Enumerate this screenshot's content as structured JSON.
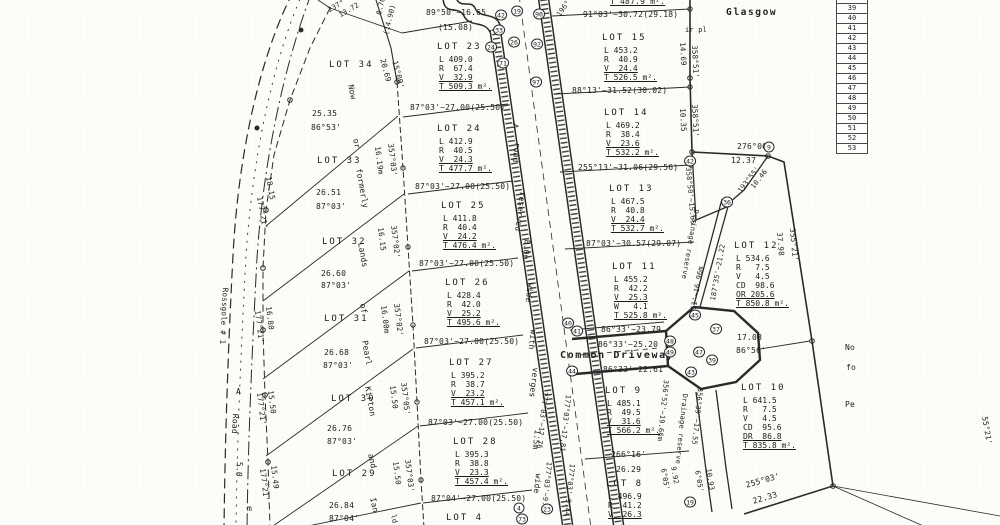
{
  "colors": {
    "ink": "#1c1c1c",
    "paper": "#fcfcf9"
  },
  "ref_table": {
    "rows": [
      "38",
      "39",
      "40",
      "41",
      "42",
      "43",
      "44",
      "45",
      "46",
      "47",
      "48",
      "49",
      "50",
      "51",
      "52",
      "53"
    ]
  },
  "lots": [
    {
      "name": "LOT 23",
      "x": 437,
      "y": 42,
      "rows": [
        "L 409.0",
        "R  67.4",
        "V  32.9",
        "T 509.3 m²."
      ],
      "u": [
        2,
        3
      ]
    },
    {
      "name": "LOT 24",
      "x": 437,
      "y": 124,
      "rows": [
        "L 412.9",
        "R  40.5",
        "V  24.3",
        "T 477.7 m²."
      ],
      "u": [
        2,
        3
      ]
    },
    {
      "name": "LOT 25",
      "x": 441,
      "y": 201,
      "rows": [
        "L 411.8",
        "R  40.4",
        "V  24.2",
        "T 476.4 m²."
      ],
      "u": [
        2,
        3
      ]
    },
    {
      "name": "LOT 26",
      "x": 445,
      "y": 278,
      "rows": [
        "L 428.4",
        "R  42.0",
        "V  25.2",
        "T 495.6 m²."
      ],
      "u": [
        2,
        3
      ]
    },
    {
      "name": "LOT 27",
      "x": 449,
      "y": 358,
      "rows": [
        "L 395.2",
        "R  38.7",
        "V  23.2",
        "T 457.1 m²."
      ],
      "u": [
        2,
        3
      ]
    },
    {
      "name": "LOT 28",
      "x": 453,
      "y": 437,
      "rows": [
        "L 395.3",
        "R  38.8",
        "V  23.3",
        "T 457.4 m²."
      ],
      "u": [
        2,
        3
      ]
    },
    {
      "name": "LOT 15",
      "x": 602,
      "y": 33,
      "rows": [
        "L 453.2",
        "R  40.9",
        "V  24.4",
        "T 526.5 m²."
      ],
      "u": [
        2,
        3
      ]
    },
    {
      "name": "LOT 14",
      "x": 604,
      "y": 108,
      "rows": [
        "L 469.2",
        "R  38.4",
        "V  23.6",
        "T 532.2 m²."
      ],
      "u": [
        2,
        3
      ]
    },
    {
      "name": "LOT 13",
      "x": 609,
      "y": 184,
      "rows": [
        "L 467.5",
        "R  40.8",
        "V  24.4",
        "T 532.7 m²."
      ],
      "u": [
        2,
        3
      ]
    },
    {
      "name": "LOT 11",
      "x": 612,
      "y": 262,
      "rows": [
        "L 455.2",
        "R  42.2",
        "V  25.3",
        "W   4.1",
        "T 525.8 m²."
      ],
      "u": [
        2,
        4
      ]
    },
    {
      "name": "LOT 12",
      "x": 734,
      "y": 241,
      "rows": [
        "L 534.6",
        "R   7.5",
        "V   4.5",
        "CD  98.6",
        "OR 205.6",
        "T 850.8 m²."
      ],
      "u": [
        4,
        5
      ]
    },
    {
      "name": "LOT 9",
      "x": 605,
      "y": 386,
      "rows": [
        "L 485.1",
        "R  49.5",
        "V  31.6",
        "T 566.2 m²."
      ],
      "u": [
        2,
        3
      ]
    },
    {
      "name": "LOT 10",
      "x": 741,
      "y": 383,
      "rows": [
        "L 641.5",
        "R   7.5",
        "V   4.5",
        "CD  95.6",
        "DR  86.8",
        "T 835.8 m²."
      ],
      "u": [
        4,
        5
      ]
    },
    {
      "name": "LOT 8",
      "x": 606,
      "y": 479,
      "rows": [
        "L 496.9",
        "R  41.2",
        "V  26.3"
      ],
      "u": [
        2
      ]
    },
    {
      "name": "LOT 34",
      "x": 329,
      "y": 60,
      "rows": [],
      "u": []
    },
    {
      "name": "LOT 33",
      "x": 317,
      "y": 156,
      "rows": [],
      "u": []
    },
    {
      "name": "LOT 32",
      "x": 322,
      "y": 237,
      "rows": [],
      "u": []
    },
    {
      "name": "LOT 31",
      "x": 324,
      "y": 314,
      "rows": [],
      "u": []
    },
    {
      "name": "LOT 30",
      "x": 331,
      "y": 394,
      "rows": [],
      "u": []
    },
    {
      "name": "LOT 29",
      "x": 332,
      "y": 469,
      "rows": [],
      "u": []
    },
    {
      "name": "LOT 4",
      "x": 446,
      "y": 513,
      "rows": [],
      "u": []
    }
  ],
  "labels": [
    {
      "t": "T 487.9 m².",
      "x": 610,
      "y": -2,
      "u": 1
    },
    {
      "t": "89°50'~16.65",
      "x": 426,
      "y": 9
    },
    {
      "t": "(15.08)",
      "x": 438,
      "y": 24
    },
    {
      "t": "91°03'~30.72(29.18)",
      "x": 583,
      "y": 11
    },
    {
      "t": "88°13'~31.52(30.02)",
      "x": 572,
      "y": 87
    },
    {
      "t": "255°13'~31.06(29.56)",
      "x": 578,
      "y": 164
    },
    {
      "t": "87°03'~30.57(29.07)",
      "x": 586,
      "y": 240
    },
    {
      "t": "87°03'~27.00(25.50)",
      "x": 410,
      "y": 104
    },
    {
      "t": "87°03'~27.00(25.50)",
      "x": 415,
      "y": 183
    },
    {
      "t": "87°03'~27.00(25.50)",
      "x": 419,
      "y": 260
    },
    {
      "t": "87°03'~27.00(25.50)",
      "x": 424,
      "y": 338
    },
    {
      "t": "87°03'~27.00(25.50)",
      "x": 428,
      "y": 419
    },
    {
      "t": "87°04'~27.00(25.50)",
      "x": 431,
      "y": 495
    },
    {
      "t": "86°33'~23.79",
      "x": 601,
      "y": 326
    },
    {
      "t": "86°33'~25.20",
      "x": 598,
      "y": 341
    },
    {
      "t": "Common Driveway",
      "x": 560,
      "y": 351,
      "s": 10,
      "b": 1
    },
    {
      "t": "86°33'~22.61",
      "x": 603,
      "y": 366
    },
    {
      "t": "266°16'",
      "x": 611,
      "y": 451
    },
    {
      "t": "26.29",
      "x": 616,
      "y": 466
    },
    {
      "t": "Glasgow",
      "x": 726,
      "y": 8,
      "s": 9.5,
      "b": 1
    },
    {
      "t": "276°00'",
      "x": 737,
      "y": 143
    },
    {
      "t": "12.37",
      "x": 731,
      "y": 157
    },
    {
      "t": "17.08",
      "x": 737,
      "y": 334
    },
    {
      "t": "86°56'",
      "x": 736,
      "y": 347
    },
    {
      "t": "255°03'",
      "x": 745,
      "y": 482,
      "r": -16
    },
    {
      "t": "22.33",
      "x": 752,
      "y": 498,
      "r": -16
    },
    {
      "t": "25.35",
      "x": 312,
      "y": 110
    },
    {
      "t": "86°53'",
      "x": 311,
      "y": 124
    },
    {
      "t": "26.51",
      "x": 316,
      "y": 189
    },
    {
      "t": "87°03'",
      "x": 316,
      "y": 203
    },
    {
      "t": "26.60",
      "x": 321,
      "y": 270
    },
    {
      "t": "87°03'",
      "x": 321,
      "y": 282
    },
    {
      "t": "26.68",
      "x": 324,
      "y": 349
    },
    {
      "t": "87°03'",
      "x": 323,
      "y": 362
    },
    {
      "t": "26.76",
      "x": 327,
      "y": 425
    },
    {
      "t": "87°03'",
      "x": 327,
      "y": 438
    },
    {
      "t": "26.84",
      "x": 329,
      "y": 502
    },
    {
      "t": "87°04'",
      "x": 329,
      "y": 515
    },
    {
      "t": "ir pl",
      "x": 685,
      "y": 27,
      "s": 7
    },
    {
      "t": "196°",
      "x": 556,
      "y": 14,
      "r": -55,
      "s": 7
    },
    {
      "t": "(14.90)",
      "x": 383,
      "y": 34,
      "r": -76,
      "s": 7
    },
    {
      "t": "0.70",
      "x": 376,
      "y": 14,
      "r": -76,
      "s": 7
    },
    {
      "t": "237°",
      "x": 327,
      "y": 8,
      "r": -30,
      "s": 7
    },
    {
      "t": "13.72",
      "x": 338,
      "y": 13,
      "r": -30,
      "s": 7
    },
    {
      "t": "20.69",
      "x": 386,
      "y": 58,
      "r": 75,
      "s": 7.5
    },
    {
      "t": "15°00'",
      "x": 398,
      "y": 60,
      "r": 75,
      "s": 7.5
    },
    {
      "t": "Now",
      "x": 354,
      "y": 84,
      "r": 78
    },
    {
      "t": "or",
      "x": 359,
      "y": 138,
      "r": 78
    },
    {
      "t": "formerly",
      "x": 362,
      "y": 168,
      "r": 80
    },
    {
      "t": "Lands",
      "x": 364,
      "y": 242,
      "r": 80
    },
    {
      "t": "of",
      "x": 366,
      "y": 303,
      "r": 80
    },
    {
      "t": "Pearl",
      "x": 368,
      "y": 340,
      "r": 80
    },
    {
      "t": "Kirton",
      "x": 371,
      "y": 386,
      "r": 80
    },
    {
      "t": "and",
      "x": 374,
      "y": 453,
      "r": 78
    },
    {
      "t": "Ian",
      "x": 376,
      "y": 497,
      "r": 78
    },
    {
      "t": "ld",
      "x": 396,
      "y": 514,
      "r": 78,
      "s": 7
    },
    {
      "t": "16.19m",
      "x": 381,
      "y": 146,
      "r": 83,
      "s": 7.5
    },
    {
      "t": "357°03'",
      "x": 394,
      "y": 143,
      "r": 83,
      "s": 7.5
    },
    {
      "t": "16.15",
      "x": 384,
      "y": 227,
      "r": 83,
      "s": 7.5
    },
    {
      "t": "357°02'",
      "x": 397,
      "y": 225,
      "r": 83,
      "s": 7.5
    },
    {
      "t": "16.00m",
      "x": 387,
      "y": 305,
      "r": 83,
      "s": 7.5
    },
    {
      "t": "357°02'",
      "x": 400,
      "y": 303,
      "r": 83,
      "s": 7.5
    },
    {
      "t": "15.50",
      "x": 396,
      "y": 385,
      "r": 83,
      "s": 7.5
    },
    {
      "t": "357°05'",
      "x": 407,
      "y": 382,
      "r": 83,
      "s": 7.5
    },
    {
      "t": "15.50",
      "x": 399,
      "y": 461,
      "r": 83,
      "s": 7.5
    },
    {
      "t": "357°03'",
      "x": 411,
      "y": 459,
      "r": 83,
      "s": 7.5
    },
    {
      "t": "Rossgole # 1",
      "x": 229,
      "y": 288,
      "r": 93,
      "s": 7.5
    },
    {
      "t": "A",
      "x": 236,
      "y": 388
    },
    {
      "t": "Road",
      "x": 239,
      "y": 414,
      "r": 93
    },
    {
      "t": "5.0",
      "x": 243,
      "y": 462,
      "r": 93
    },
    {
      "t": "m",
      "x": 247,
      "y": 505
    },
    {
      "t": "18.15",
      "x": 272,
      "y": 176,
      "r": 80,
      "s": 7.5
    },
    {
      "t": "177°21'",
      "x": 263,
      "y": 196,
      "r": 80,
      "s": 7.5
    },
    {
      "t": "16.80",
      "x": 272,
      "y": 306,
      "r": 83,
      "s": 7.5
    },
    {
      "t": "177°21'",
      "x": 261,
      "y": 310,
      "r": 83,
      "s": 7.5
    },
    {
      "t": "15.50",
      "x": 274,
      "y": 390,
      "r": 83,
      "s": 7.5
    },
    {
      "t": "177°21'",
      "x": 263,
      "y": 392,
      "r": 83,
      "s": 7.5
    },
    {
      "t": "15.49",
      "x": 277,
      "y": 465,
      "r": 83,
      "s": 7.5
    },
    {
      "t": "177°21'",
      "x": 266,
      "y": 468,
      "r": 83,
      "s": 7.5
    },
    {
      "t": "A",
      "x": 519,
      "y": 124,
      "r": 97
    },
    {
      "t": "road",
      "x": 521,
      "y": 143,
      "r": 97
    },
    {
      "t": "reserved",
      "x": 526,
      "y": 192,
      "r": 97
    },
    {
      "t": "8.0m",
      "x": 531,
      "y": 240,
      "r": 97
    },
    {
      "t": "wide",
      "x": 534,
      "y": 283,
      "r": 97
    },
    {
      "t": "with",
      "x": 537,
      "y": 330,
      "r": 97
    },
    {
      "t": "verges",
      "x": 539,
      "y": 368,
      "r": 97
    },
    {
      "t": "1.5m",
      "x": 541,
      "y": 430,
      "r": 97
    },
    {
      "t": "wide",
      "x": 542,
      "y": 474,
      "r": 97
    },
    {
      "t": "177°03'~17.76",
      "x": 548,
      "y": 392,
      "r": 96,
      "s": 7
    },
    {
      "t": "177°03'~17.81",
      "x": 571,
      "y": 395,
      "r": 96,
      "s": 7
    },
    {
      "t": "177°03'~9.42",
      "x": 552,
      "y": 462,
      "r": 96,
      "s": 7
    },
    {
      "t": "177°03'~9.44",
      "x": 575,
      "y": 464,
      "r": 96,
      "s": 7
    },
    {
      "t": "14.69",
      "x": 686,
      "y": 42,
      "r": 87,
      "s": 7.5
    },
    {
      "t": "358°51'",
      "x": 698,
      "y": 45,
      "r": 87,
      "s": 7.5
    },
    {
      "t": "10.35",
      "x": 686,
      "y": 108,
      "r": 87,
      "s": 7.5
    },
    {
      "t": "358°51'",
      "x": 698,
      "y": 104,
      "r": 87,
      "s": 7.5
    },
    {
      "t": "358°50'~15.65",
      "x": 691,
      "y": 167,
      "r": 85,
      "s": 7
    },
    {
      "t": "Drainage reserve",
      "x": 699,
      "y": 210,
      "r": 100,
      "s": 7
    },
    {
      "t": "187°35'~21.22",
      "x": 710,
      "y": 300,
      "r": -80,
      "s": 7
    },
    {
      "t": "193°55'",
      "x": 737,
      "y": 190,
      "r": -52,
      "s": 7
    },
    {
      "t": "10.46",
      "x": 750,
      "y": 186,
      "r": -52,
      "s": 7
    },
    {
      "t": "37.98",
      "x": 783,
      "y": 232,
      "r": 85,
      "s": 7.5
    },
    {
      "t": "355°21'",
      "x": 796,
      "y": 228,
      "r": 85,
      "s": 7.5
    },
    {
      "t": "8°11'~16.96m",
      "x": 689,
      "y": 318,
      "r": -80,
      "s": 7
    },
    {
      "t": "356°52'~19.66m",
      "x": 669,
      "y": 380,
      "r": 96,
      "s": 7
    },
    {
      "t": "Drainage reserve",
      "x": 688,
      "y": 394,
      "r": 96,
      "s": 7
    },
    {
      "t": "356°39'~17.55",
      "x": 703,
      "y": 388,
      "r": 96,
      "s": 7
    },
    {
      "t": "6°05'",
      "x": 666,
      "y": 468,
      "r": 80,
      "s": 7
    },
    {
      "t": "9.92",
      "x": 676,
      "y": 466,
      "r": 80,
      "s": 7
    },
    {
      "t": "6°05'",
      "x": 700,
      "y": 470,
      "r": 80,
      "s": 7
    },
    {
      "t": "10.93",
      "x": 711,
      "y": 468,
      "r": 80,
      "s": 7
    },
    {
      "t": "No",
      "x": 845,
      "y": 344
    },
    {
      "t": "fo",
      "x": 846,
      "y": 364
    },
    {
      "t": "Pe",
      "x": 845,
      "y": 401
    },
    {
      "t": "55°21'",
      "x": 988,
      "y": 416,
      "r": 80,
      "s": 7.5
    }
  ],
  "circles": [
    {
      "n": "42",
      "x": 501,
      "y": 15
    },
    {
      "n": "19",
      "x": 517,
      "y": 11
    },
    {
      "n": "33",
      "x": 499,
      "y": 30
    },
    {
      "n": "24",
      "x": 491,
      "y": 47
    },
    {
      "n": "26",
      "x": 514,
      "y": 42
    },
    {
      "n": "71",
      "x": 503,
      "y": 63
    },
    {
      "n": "90",
      "x": 539,
      "y": 14
    },
    {
      "n": "92",
      "x": 537,
      "y": 44
    },
    {
      "n": "97",
      "x": 536,
      "y": 82
    },
    {
      "n": "9",
      "x": 769,
      "y": 147
    },
    {
      "n": "42",
      "x": 690,
      "y": 161
    },
    {
      "n": "36",
      "x": 727,
      "y": 202
    },
    {
      "n": "40",
      "x": 568,
      "y": 323
    },
    {
      "n": "41",
      "x": 577,
      "y": 331
    },
    {
      "n": "44",
      "x": 572,
      "y": 371
    },
    {
      "n": "45",
      "x": 695,
      "y": 315
    },
    {
      "n": "37",
      "x": 716,
      "y": 329
    },
    {
      "n": "48",
      "x": 670,
      "y": 341
    },
    {
      "n": "49",
      "x": 670,
      "y": 352
    },
    {
      "n": "47",
      "x": 699,
      "y": 352
    },
    {
      "n": "43",
      "x": 691,
      "y": 372
    },
    {
      "n": "39",
      "x": 712,
      "y": 360
    },
    {
      "n": "19",
      "x": 690,
      "y": 502
    },
    {
      "n": "4",
      "x": 519,
      "y": 508
    },
    {
      "n": "73",
      "x": 522,
      "y": 519
    },
    {
      "n": "23",
      "x": 547,
      "y": 509
    }
  ]
}
